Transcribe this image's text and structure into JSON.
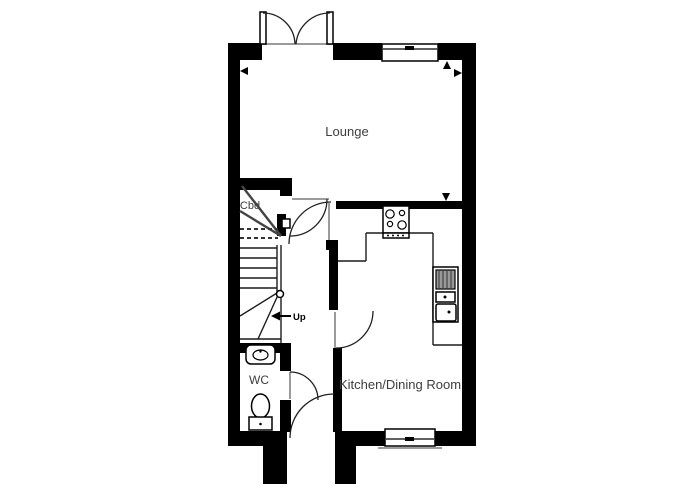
{
  "floorplan": {
    "labels": {
      "lounge": "Lounge",
      "kitchen": "Kitchen/Dining Room",
      "wc": "WC",
      "cupboard": "Cbd",
      "stairs_direction": "Up"
    },
    "colors": {
      "wall": "#000000",
      "line": "#1c1c1c",
      "thin": "#3a3a3a",
      "jamb": "#9b9b9b",
      "text": "#3d3d3d"
    }
  }
}
